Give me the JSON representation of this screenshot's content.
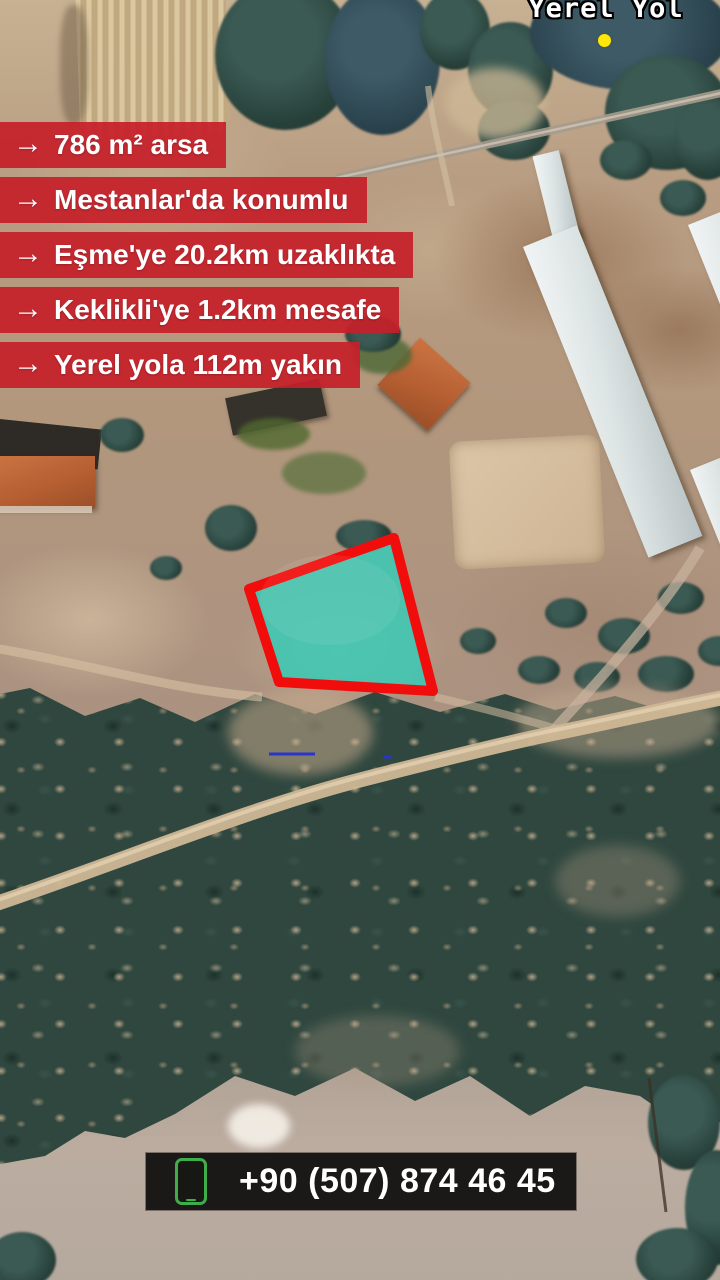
{
  "map": {
    "road_label": "Yerel Yol",
    "marker_color": "#ffe70a"
  },
  "listing": {
    "arrow": "→",
    "banner_color": "rgba(198,32,42,0.93)",
    "features": [
      "786 m² arsa",
      "Mestanlar'da konumlu",
      "Eşme'ye 20.2km uzaklıkta",
      "Keklikli'ye 1.2km mesafe",
      "Yerel yola 112m yakın"
    ]
  },
  "plot_highlight": {
    "fill": "#3cc8b4",
    "stroke": "#f20d0d"
  },
  "contact": {
    "phone": "+90 (507) 874 46 45",
    "icon": "phone-icon",
    "icon_color": "#3fae4a",
    "bar_color": "rgba(13,12,11,0.92)"
  }
}
